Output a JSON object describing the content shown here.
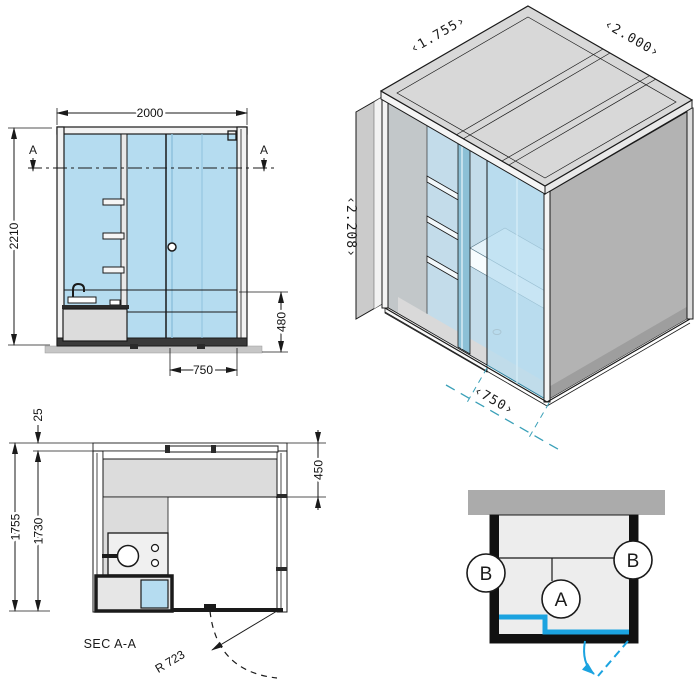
{
  "drawing": {
    "elevation": {
      "dim_width": "2000",
      "dim_height": "2210",
      "dim_bench_height": "480",
      "dim_door_width": "750",
      "section_marker": "A"
    },
    "isometric": {
      "dim_depth": "‹1.755›",
      "dim_width": "‹2.000›",
      "dim_height": "‹2.208›",
      "dim_door": "‹750›"
    },
    "plan": {
      "title": "SEC A-A",
      "dim_ledge": "25",
      "dim_depth_outer": "1755",
      "dim_depth_inner": "1730",
      "dim_bench_depth": "450",
      "door_radius": "R 723"
    },
    "schematic": {
      "label_a": "A",
      "label_b_left": "B",
      "label_b_right": "B"
    },
    "colors": {
      "glass_blue": "#b5dcf0",
      "glass_deep": "#8cc0d6",
      "accent_teal": "#3aa0b8",
      "accent_blue": "#1ba3e0",
      "panel_gray": "#d8d8d8",
      "wall_gray": "#b3b3b3",
      "line_dark": "#1a1a1a"
    }
  }
}
